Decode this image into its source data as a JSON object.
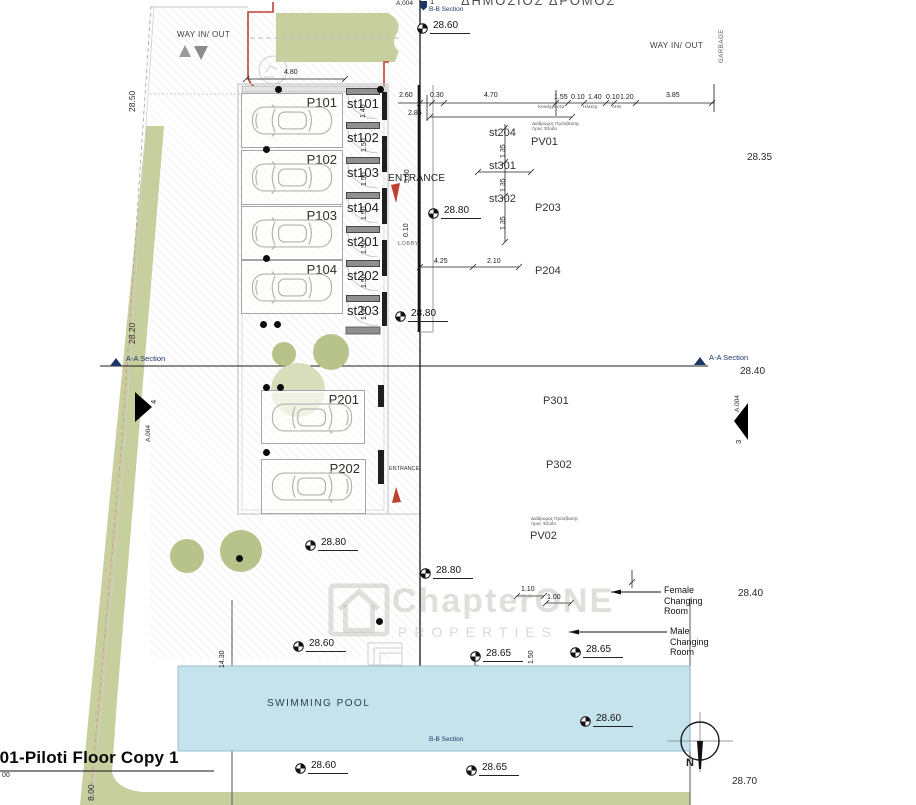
{
  "title": {
    "text": "001-Piloti Floor Copy 1"
  },
  "street": {
    "name": "ΔΗΜΟΣΙΟΣ ΔΡΟΜΟΣ"
  },
  "way": {
    "left": "WAY IN/ OUT",
    "right": "WAY IN/ OUT",
    "garbage": "GARBAGE"
  },
  "sections": {
    "aa_left": "A-A Section",
    "aa_right": "A-A Section",
    "bb_top": "B-B Section",
    "bb_bottom": "B-B Section",
    "sheet_top": "A.004",
    "bubble_top": "1",
    "arrow_left_num": "4",
    "arrow_left_sheet": "A.004",
    "arrow_right_num": "3",
    "arrow_right_sheet": "A.004"
  },
  "entrances": {
    "main": "ENTRANCE",
    "side": "ENTRANCE",
    "lobby": "LOBBY"
  },
  "pool": {
    "label": "SWIMMING POOL"
  },
  "compass": {
    "north": "N"
  },
  "watermark": {
    "line1": "ChapterONE",
    "line2": "PROPERTIES"
  },
  "changing_rooms": {
    "female": [
      "Female",
      "Changing",
      "Room"
    ],
    "male": [
      "Male",
      "Changing",
      "Room"
    ]
  },
  "greek_notes": {
    "pv01": [
      "Διάδρομος Πρόσβασης",
      "προς  Έξοδο"
    ],
    "pv02": [
      "Διάδρομος Πρόσβασης",
      "προς  Έξοδο"
    ],
    "utilities": [
      "Κοινόχρηστα",
      "Ηλεκτρ.",
      "ΑΗΚ"
    ]
  },
  "parking": {
    "stalls": [
      {
        "label": "P101",
        "x": 241,
        "y": 93,
        "w": 100,
        "h": 53,
        "flip": false
      },
      {
        "label": "P102",
        "x": 241,
        "y": 150,
        "w": 100,
        "h": 53,
        "flip": false
      },
      {
        "label": "P103",
        "x": 241,
        "y": 206,
        "w": 100,
        "h": 52,
        "flip": false
      },
      {
        "label": "P104",
        "x": 241,
        "y": 260,
        "w": 100,
        "h": 52,
        "flip": false
      },
      {
        "label": "P201",
        "x": 261,
        "y": 390,
        "w": 102,
        "h": 52,
        "flip": true
      },
      {
        "label": "P202",
        "x": 261,
        "y": 459,
        "w": 103,
        "h": 53,
        "flip": true
      }
    ]
  },
  "storage": {
    "units": [
      {
        "label": "st101",
        "y": 88
      },
      {
        "label": "st102",
        "y": 122
      },
      {
        "label": "st103",
        "y": 157
      },
      {
        "label": "st104",
        "y": 192
      },
      {
        "label": "st201",
        "y": 226
      },
      {
        "label": "st202",
        "y": 260
      },
      {
        "label": "st203",
        "y": 295
      }
    ]
  },
  "plan_labels": [
    {
      "t": "st204",
      "x": 489,
      "y": 127
    },
    {
      "t": "st301",
      "x": 489,
      "y": 160
    },
    {
      "t": "st302",
      "x": 489,
      "y": 193
    },
    {
      "t": "PV01",
      "x": 531,
      "y": 136
    },
    {
      "t": "P203",
      "x": 535,
      "y": 202
    },
    {
      "t": "P204",
      "x": 535,
      "y": 265
    },
    {
      "t": "P301",
      "x": 543,
      "y": 395
    },
    {
      "t": "P302",
      "x": 546,
      "y": 459
    },
    {
      "t": "PV02",
      "x": 530,
      "y": 530
    }
  ],
  "dimensions": [
    {
      "t": "4.80",
      "x": 284,
      "y": 69
    },
    {
      "t": "2.60",
      "x": 399,
      "y": 92
    },
    {
      "t": "0.30",
      "x": 430,
      "y": 92
    },
    {
      "t": "4.70",
      "x": 484,
      "y": 92
    },
    {
      "t": "1.55",
      "x": 554,
      "y": 94
    },
    {
      "t": "0.10",
      "x": 571,
      "y": 94
    },
    {
      "t": "1.40",
      "x": 588,
      "y": 94
    },
    {
      "t": "0.10",
      "x": 606,
      "y": 94
    },
    {
      "t": "1.20",
      "x": 620,
      "y": 94
    },
    {
      "t": "3.85",
      "x": 666,
      "y": 92
    },
    {
      "t": "2.85",
      "x": 408,
      "y": 110
    },
    {
      "t": "4.25",
      "x": 434,
      "y": 258
    },
    {
      "t": "2.10",
      "x": 487,
      "y": 258
    },
    {
      "t": "1.10",
      "x": 521,
      "y": 586
    },
    {
      "t": "1.00",
      "x": 547,
      "y": 594
    },
    {
      "t": "1.40",
      "x": 360,
      "y": 118,
      "rot": true
    },
    {
      "t": "1.50",
      "x": 361,
      "y": 152,
      "rot": true
    },
    {
      "t": "1.50",
      "x": 361,
      "y": 186,
      "rot": true
    },
    {
      "t": "1.50",
      "x": 361,
      "y": 220,
      "rot": true
    },
    {
      "t": "1.50",
      "x": 361,
      "y": 254,
      "rot": true
    },
    {
      "t": "1.50",
      "x": 361,
      "y": 288,
      "rot": true
    },
    {
      "t": "1.60",
      "x": 361,
      "y": 320,
      "rot": true
    },
    {
      "t": "5.60",
      "x": 404,
      "y": 183,
      "rot": true
    },
    {
      "t": "0.10",
      "x": 403,
      "y": 237,
      "rot": true
    },
    {
      "t": "1.35",
      "x": 500,
      "y": 158,
      "rot": true
    },
    {
      "t": "1.35",
      "x": 500,
      "y": 192,
      "rot": true
    },
    {
      "t": "1.35",
      "x": 500,
      "y": 230,
      "rot": true
    },
    {
      "t": "1.50",
      "x": 528,
      "y": 664,
      "rot": true
    },
    {
      "t": "14.30",
      "x": 219,
      "y": 668,
      "rot": true
    }
  ],
  "elevations": [
    {
      "v": "28.60",
      "x": 417,
      "y": 20,
      "s": "sym"
    },
    {
      "v": "28.70",
      "x": 752,
      "y": -8,
      "s": "plain"
    },
    {
      "v": "28.35",
      "x": 747,
      "y": 152,
      "s": "plain"
    },
    {
      "v": "28.80",
      "x": 428,
      "y": 205,
      "s": "sym"
    },
    {
      "v": "28.80",
      "x": 395,
      "y": 308,
      "s": "sym"
    },
    {
      "v": "28.40",
      "x": 740,
      "y": 366,
      "s": "plain"
    },
    {
      "v": "28.80",
      "x": 305,
      "y": 537,
      "s": "sym"
    },
    {
      "v": "28.80",
      "x": 420,
      "y": 565,
      "s": "sym"
    },
    {
      "v": "28.40",
      "x": 738,
      "y": 588,
      "s": "plain"
    },
    {
      "v": "28.60",
      "x": 293,
      "y": 638,
      "s": "sym"
    },
    {
      "v": "28.65",
      "x": 470,
      "y": 648,
      "s": "sym"
    },
    {
      "v": "28.65",
      "x": 570,
      "y": 644,
      "s": "sym"
    },
    {
      "v": "28.60",
      "x": 580,
      "y": 713,
      "s": "sym"
    },
    {
      "v": "28.65",
      "x": 466,
      "y": 762,
      "s": "sym"
    },
    {
      "v": "28.60",
      "x": 295,
      "y": 760,
      "s": "sym"
    },
    {
      "v": "28.70",
      "x": 732,
      "y": 776,
      "s": "plain"
    },
    {
      "v": "28.50",
      "x": 127,
      "y": 112,
      "s": "rot"
    },
    {
      "v": "28.20",
      "x": 127,
      "y": 344,
      "s": "rot"
    },
    {
      "v": "8.00",
      "x": 86,
      "y": 801,
      "s": "rot"
    },
    {
      "v": "00",
      "x": 2,
      "y": 772,
      "s": "plain-sm"
    }
  ],
  "dots": [
    [
      278,
      89
    ],
    [
      380,
      89
    ],
    [
      266,
      149
    ],
    [
      266,
      258
    ],
    [
      263,
      324
    ],
    [
      277,
      324
    ],
    [
      266,
      387
    ],
    [
      280,
      387
    ],
    [
      266,
      452
    ],
    [
      379,
      621
    ],
    [
      239,
      558
    ]
  ],
  "trees": [
    {
      "x": 298,
      "y": 390,
      "r": 27,
      "light": true
    },
    {
      "x": 284,
      "y": 354,
      "r": 12
    },
    {
      "x": 331,
      "y": 352,
      "r": 18
    },
    {
      "x": 187,
      "y": 556,
      "r": 17
    },
    {
      "x": 241,
      "y": 551,
      "r": 21
    }
  ],
  "colors": {
    "green": "#c7cf9e",
    "tree": "#b7c38a",
    "tree-light": "#d8ddbb",
    "pool": "#c4e3ed",
    "red": "#c0402f",
    "navy": "#1c3667"
  }
}
